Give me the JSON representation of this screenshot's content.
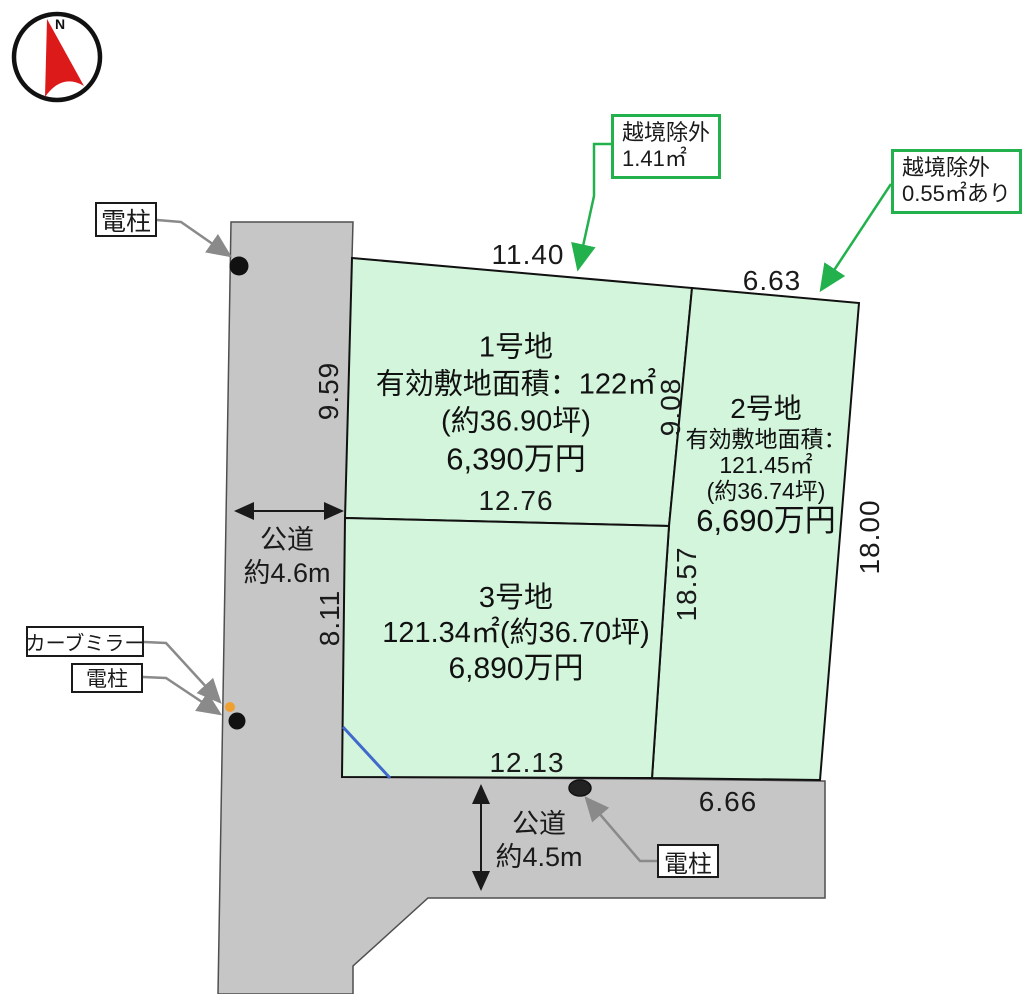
{
  "compass": {
    "north_label": "N"
  },
  "callouts": {
    "encroachment_top": {
      "line1": "越境除外",
      "line2": "1.41㎡"
    },
    "encroachment_right": {
      "line1": "越境除外",
      "line2": "0.55㎡あり"
    }
  },
  "markers": {
    "pole_top": "電柱",
    "curve_mirror": "カーブミラー",
    "pole_left": "電柱",
    "pole_bottom": "電柱"
  },
  "roads": {
    "west": {
      "name": "公道",
      "width": "約4.6m"
    },
    "south": {
      "name": "公道",
      "width": "約4.5m"
    }
  },
  "dimensions": {
    "lot1_top": "11.40",
    "lot2_top": "6.63",
    "lot1_left": "9.59",
    "lot3_left": "8.11",
    "lot1_bottom": "12.76",
    "lot1_right": "9.08",
    "lot3_right": "18.57",
    "lot2_right": "18.00",
    "lot3_bottom": "12.13",
    "lot2_bottom": "6.66"
  },
  "lots": {
    "lot1": {
      "name": "1号地",
      "area": "有効敷地面積：122㎡",
      "tsubo": "(約36.90坪)",
      "price": "6,390万円"
    },
    "lot2": {
      "name": "2号地",
      "area_label": "有効敷地面積：",
      "area": "121.45㎡",
      "tsubo": "(約36.74坪)",
      "price": "6,690万円"
    },
    "lot3": {
      "name": "3号地",
      "area": "121.34㎡(約36.70坪)",
      "price": "6,890万円"
    }
  },
  "colors": {
    "lot_fill": "#d3f5dc",
    "road_fill": "#c6c6c6",
    "accent_green": "#22b14c",
    "compass_red": "#dd1a1a",
    "boundary_blue": "#4169cc",
    "mirror_orange": "#f0a030"
  }
}
